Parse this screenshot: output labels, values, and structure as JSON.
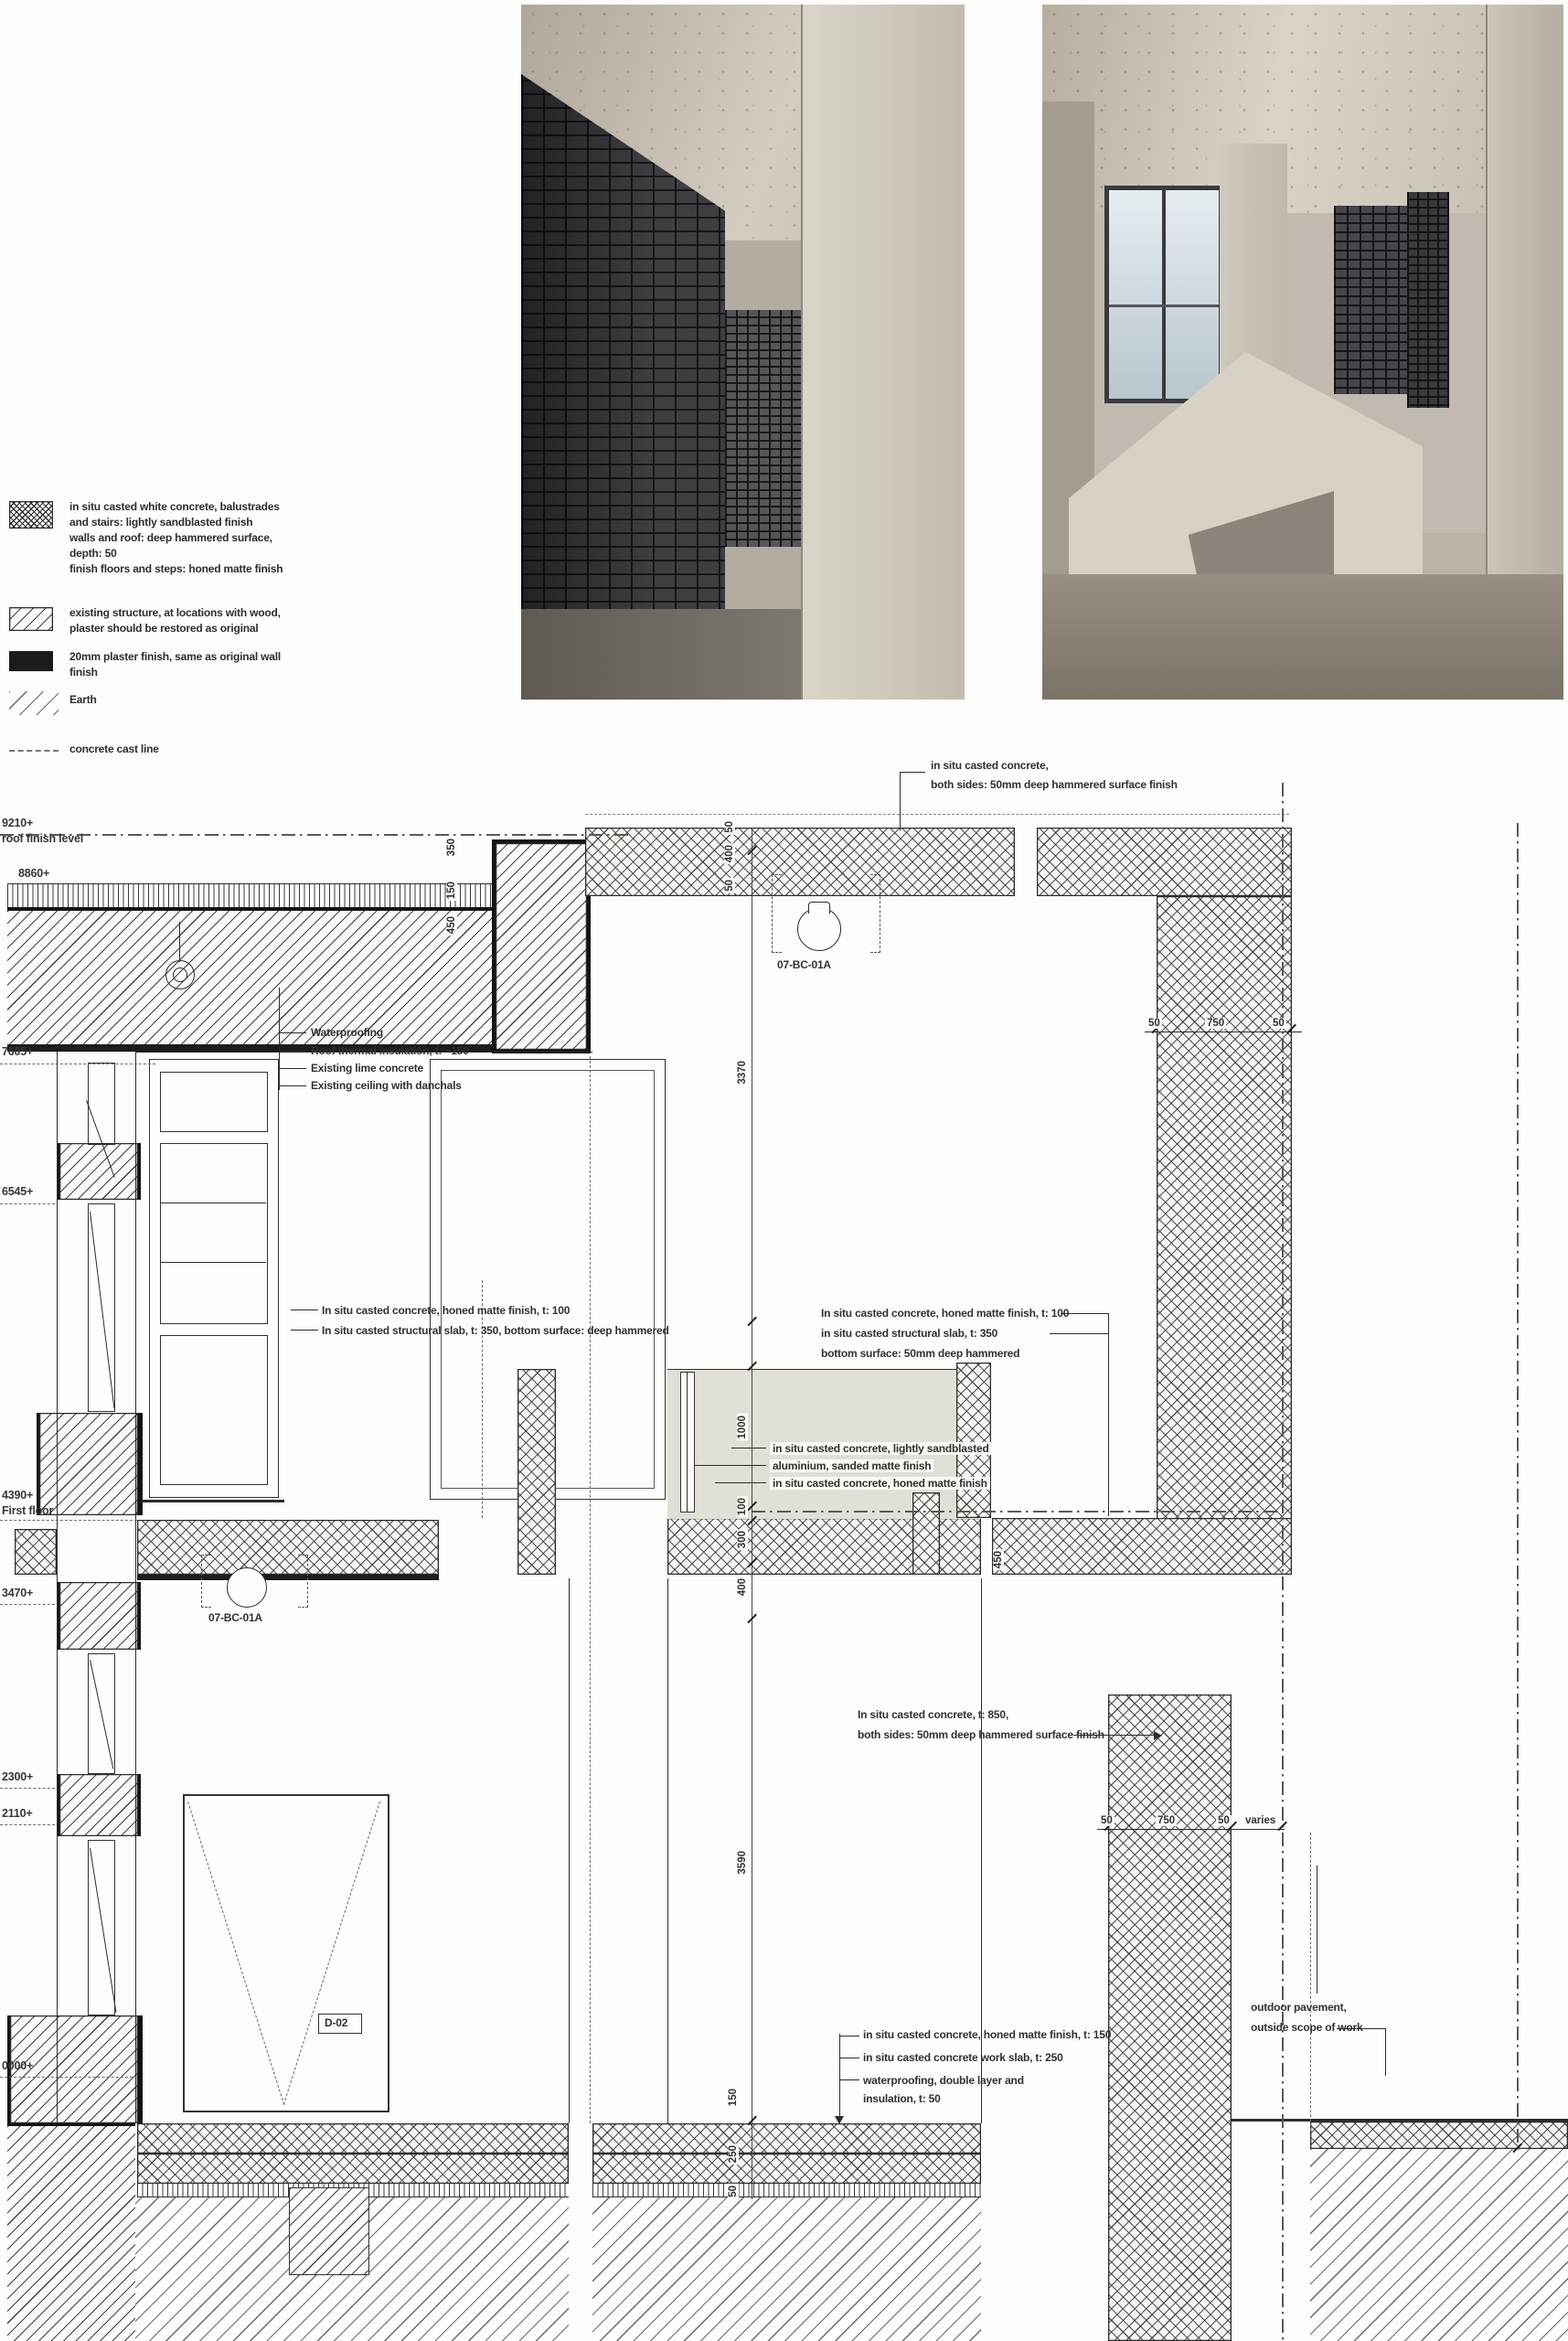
{
  "meta": {
    "title": "Construction detail section with material legend"
  },
  "photos": [
    {
      "name": "vault-corridor-photo"
    },
    {
      "name": "lobby-interior-photo"
    }
  ],
  "legend": {
    "items": [
      {
        "swatch": "crosshatch-dense-icon",
        "lines": [
          "in situ casted white concrete, balustrades",
          "and stairs: lightly sandblasted finish",
          "walls and roof: deep hammered surface,",
          "depth: 50",
          "finish floors and steps: honed matte finish"
        ]
      },
      {
        "swatch": "diagonal-hatch-icon",
        "lines": [
          "existing structure, at locations with wood,",
          "plaster should be restored as original"
        ]
      },
      {
        "swatch": "solid-black-icon",
        "lines": [
          "20mm plaster finish, same as original wall",
          "finish"
        ]
      },
      {
        "swatch": "earth-hatch-icon",
        "lines": [
          "Earth"
        ]
      },
      {
        "swatch": "dashed-line-icon",
        "lines": [
          "concrete cast line"
        ]
      }
    ]
  },
  "levels": [
    {
      "elev": "9210+",
      "name": "roof finish level"
    },
    {
      "elev": "8860+",
      "name": ""
    },
    {
      "elev": "7605+",
      "name": ""
    },
    {
      "elev": "6545+",
      "name": ""
    },
    {
      "elev": "4390+",
      "name": "First floor"
    },
    {
      "elev": "3470+",
      "name": ""
    },
    {
      "elev": "2300+",
      "name": ""
    },
    {
      "elev": "2110+",
      "name": ""
    },
    {
      "elev": "0000+",
      "name": ""
    }
  ],
  "annotations": {
    "top_wall": [
      "in situ casted concrete,",
      "both sides: 50mm deep hammered surface finish"
    ],
    "roof_buildup": [
      "Waterproofing",
      "Roof thermal insulation, t: ~150",
      "Existing lime concrete",
      "Existing ceiling with danchals"
    ],
    "slab_left": [
      "In situ casted concrete, honed matte finish, t: 100",
      "In situ casted structural slab, t: 350, bottom surface: deep hammered"
    ],
    "slab_right": [
      "In situ casted concrete, honed matte finish, t: 100",
      "in situ casted structural slab, t: 350",
      "bottom surface: 50mm deep hammered"
    ],
    "parapet": [
      "in situ casted concrete, lightly sandblasted",
      "aluminium, sanded matte finish",
      "in situ casted concrete, honed matte finish"
    ],
    "wall_850": [
      "In situ casted concrete, t: 850,",
      "both sides: 50mm deep hammered surface finish"
    ],
    "floor_buildup": [
      "in situ casted concrete, honed matte finish, t: 150",
      "in situ casted concrete work slab, t: 250",
      "waterproofing, double layer and",
      "insulation, t: 50"
    ],
    "outdoor": [
      "outdoor pavement,",
      "outside  scope of work"
    ]
  },
  "tags": {
    "detail_top": "07-BC-01A",
    "detail_mid": "07-BC-01A",
    "door": "D-02"
  },
  "dimensions": {
    "band_top": [
      "50",
      "400",
      "50"
    ],
    "parapet_v": [
      "350",
      "150",
      "450"
    ],
    "center_v": [
      "3370",
      "1000",
      "100",
      "300",
      "400",
      "3590",
      "450"
    ],
    "wall_upper": [
      "50",
      "750",
      "50"
    ],
    "wall_lower": [
      "50",
      "750",
      "50"
    ],
    "varies": "varies",
    "floor_v": [
      "150",
      "250",
      "50"
    ]
  },
  "colors": {
    "paper": "#fdfdfc",
    "ink": "#2e2c29",
    "grey_fill": "#e2dfd8",
    "plaster_black": "#1d1c1a"
  }
}
